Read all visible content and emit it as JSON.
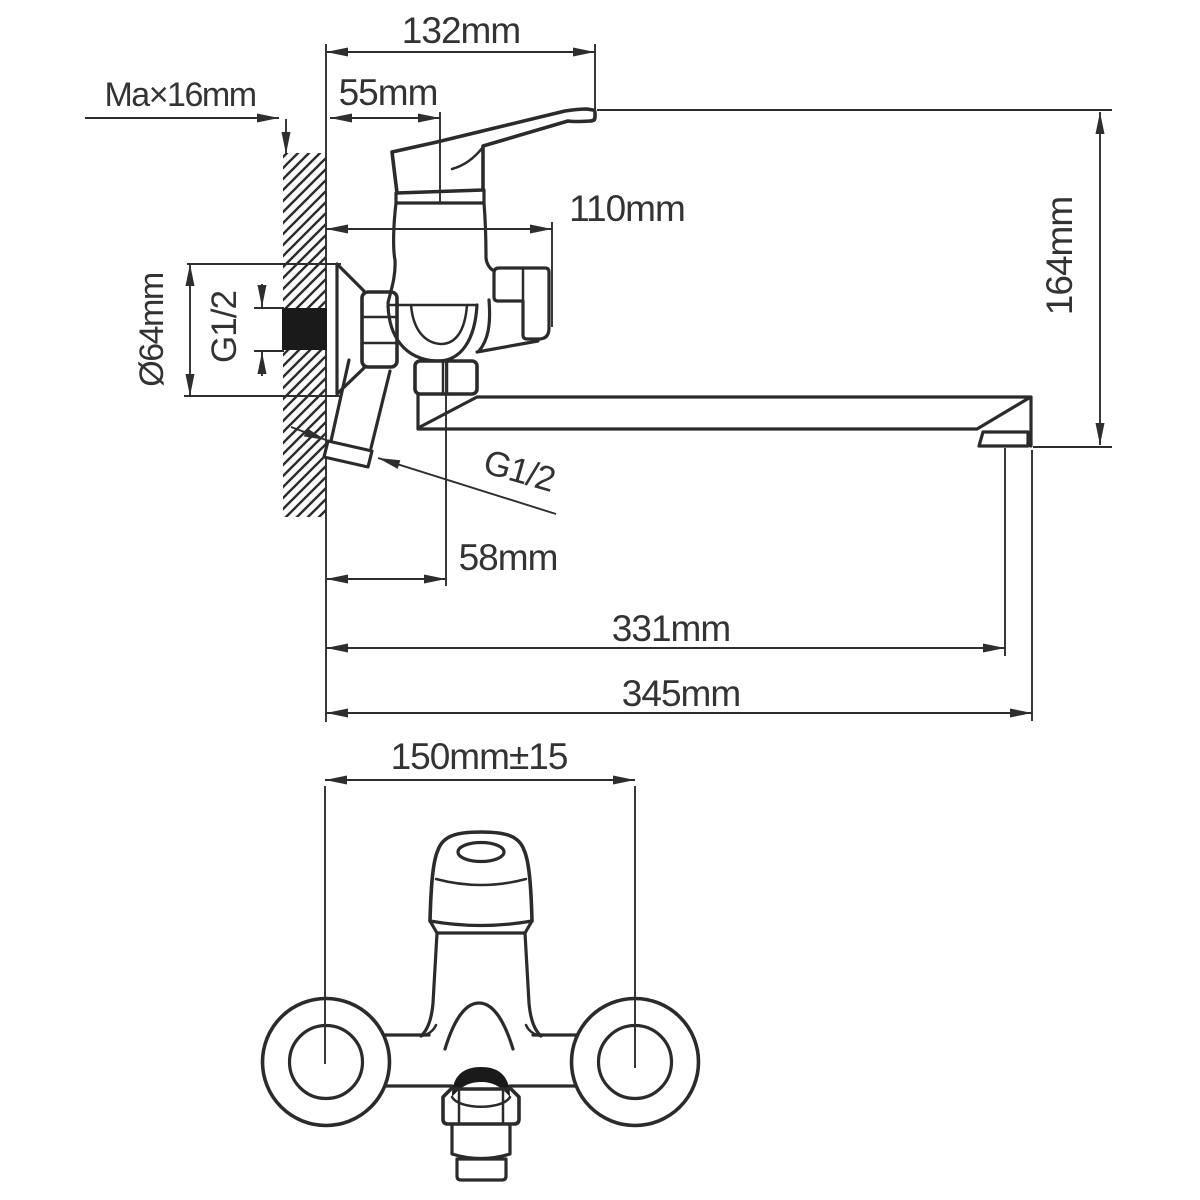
{
  "drawing": {
    "type": "technical installation drawing, wall-mounted single-lever bath mixer tap, side view and front view",
    "colors": {
      "background": "#ffffff",
      "line": "#2b2b2b",
      "text": "#333333",
      "fill_solid": "#1a1a1a"
    },
    "labels": {
      "top_width": "132mm",
      "handle_offset": "55mm",
      "wall_max": "Ma×16mm",
      "body_depth": "110mm",
      "height": "164mm",
      "flange_diameter": "Ø64mm",
      "inlet_thread": "G1/2",
      "outlet_thread": "G1/2",
      "spout_pivot_offset": "58mm",
      "reach_aerator": "331mm",
      "reach_total": "345mm",
      "mounting_centers": "150mm±15"
    }
  }
}
